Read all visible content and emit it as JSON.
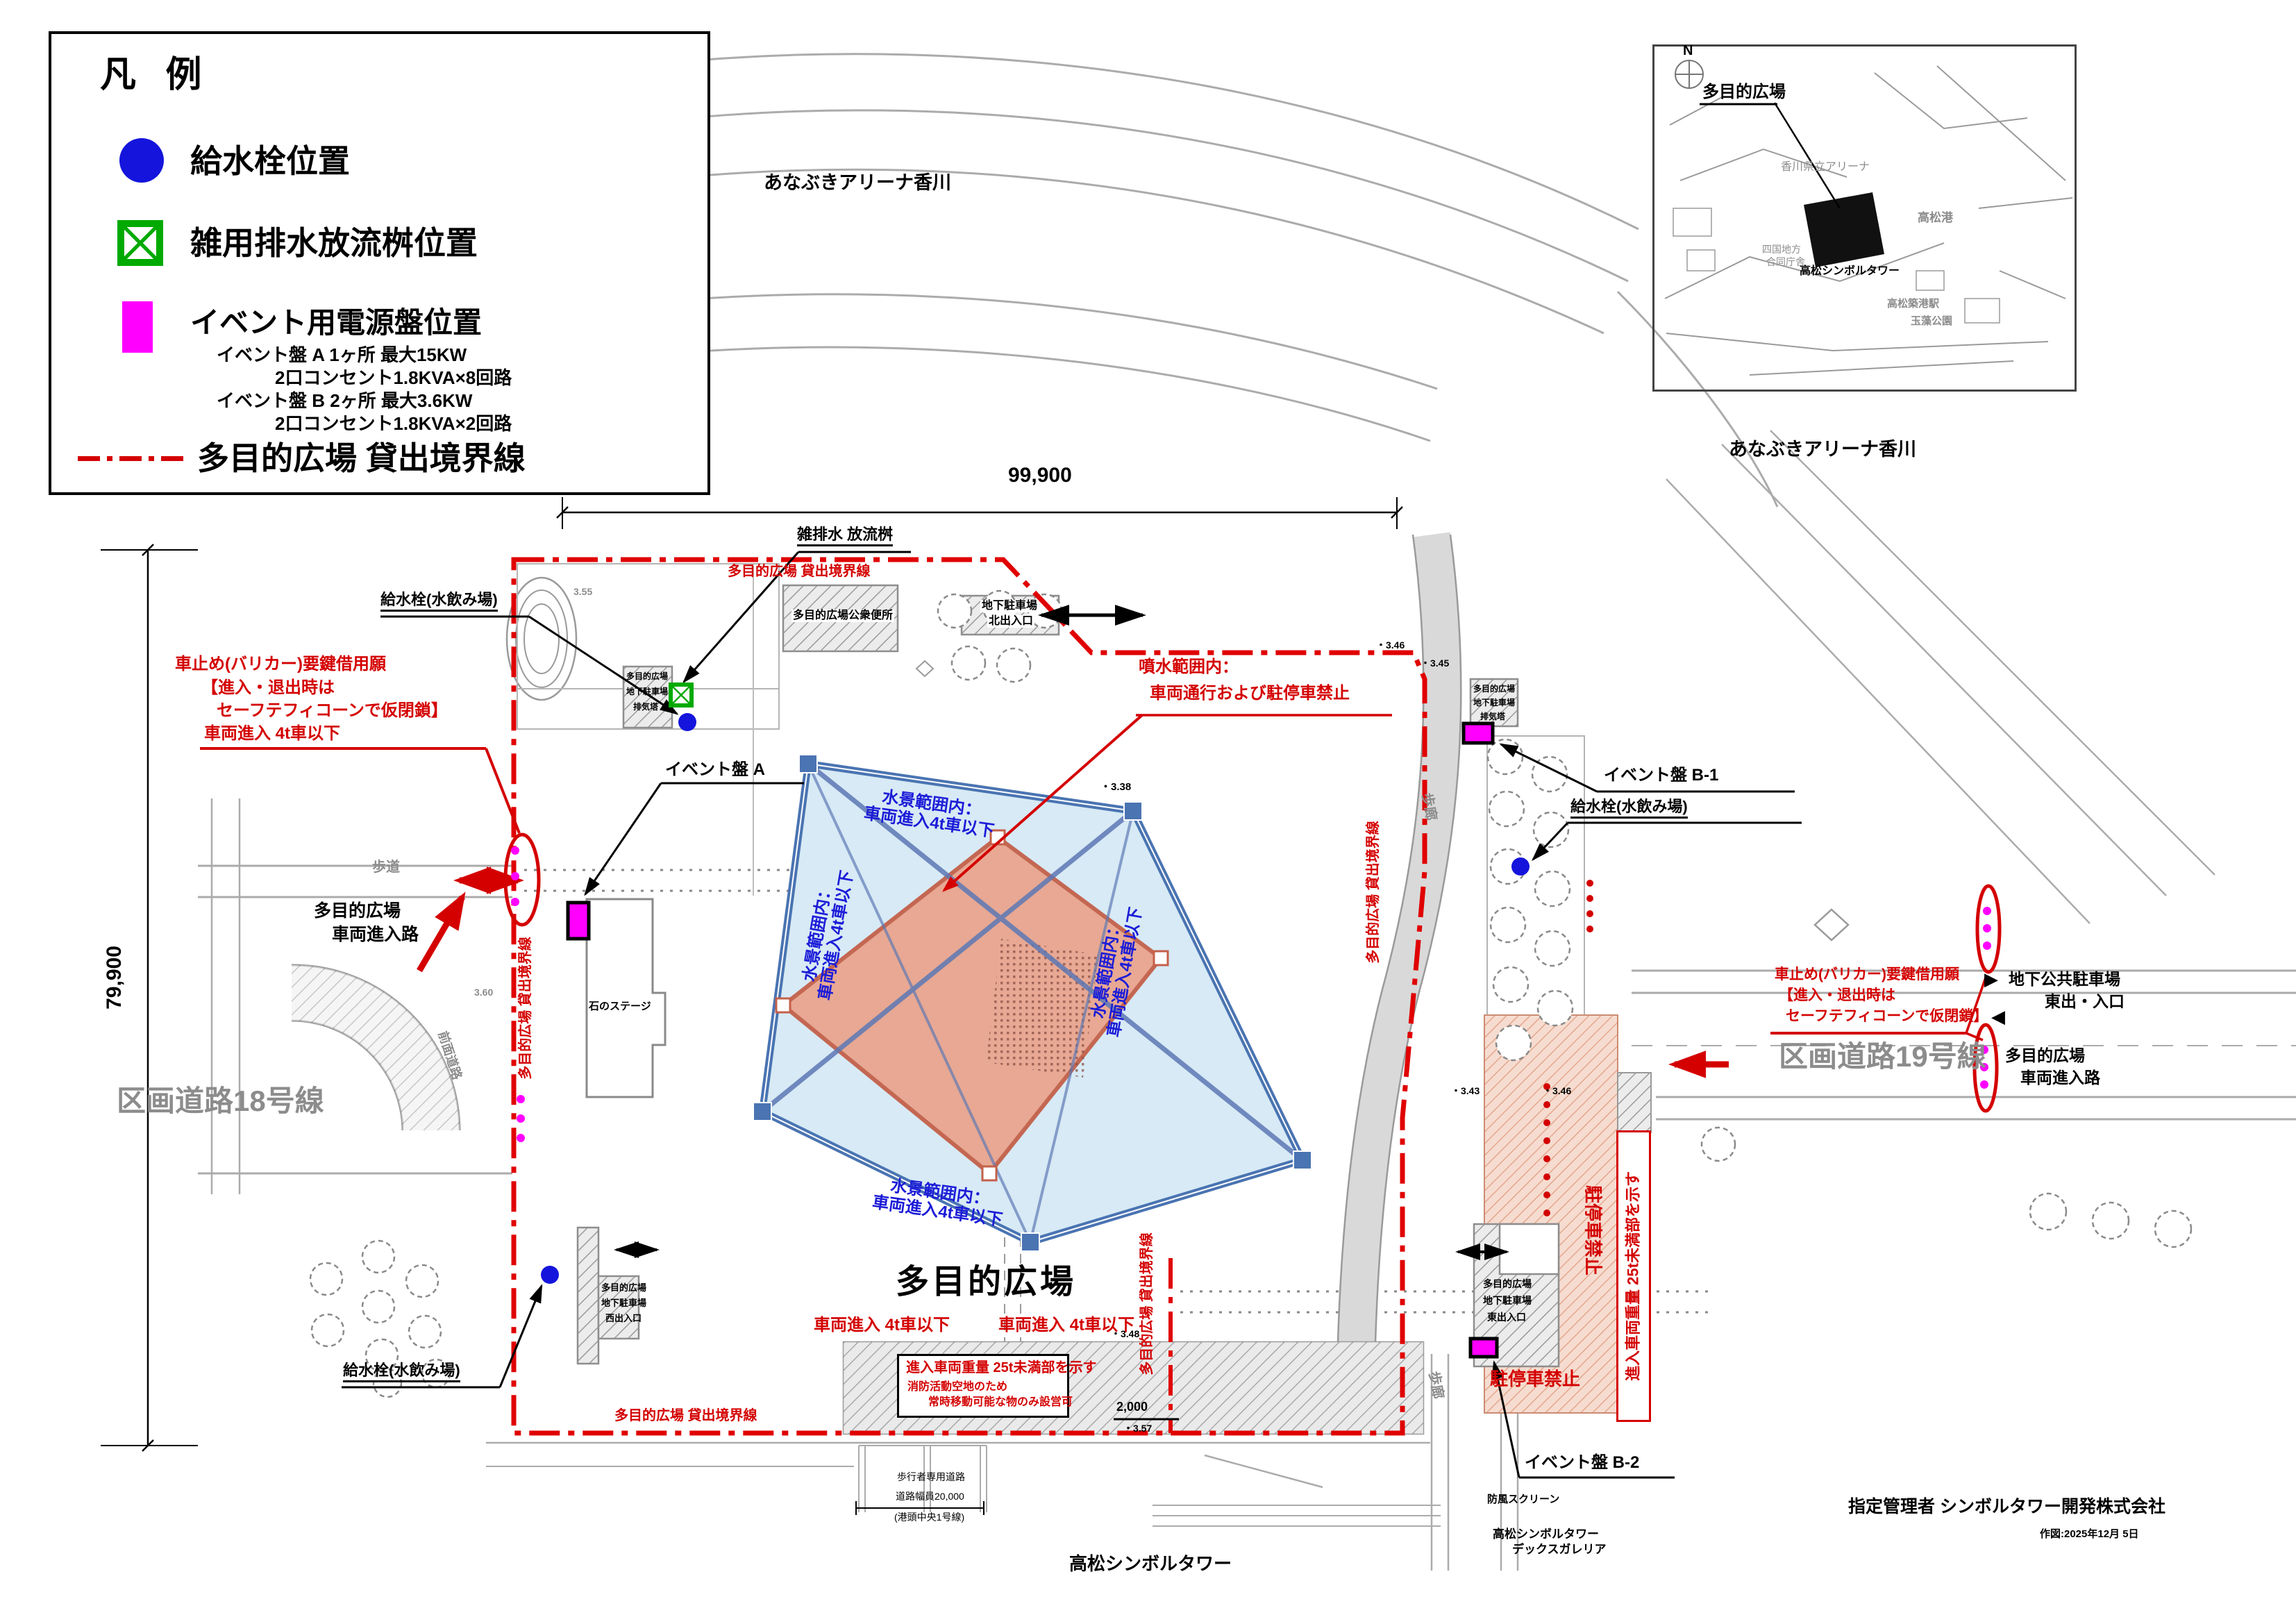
{
  "legend": {
    "title": "凡 例",
    "water_tap": "給水栓位置",
    "drain": "雑用排水放流桝位置",
    "power": "イベント用電源盤位置",
    "power_a": "イベント盤 A 1ヶ所 最大15KW",
    "power_a2": "2口コンセント1.8KVA×8回路",
    "power_b": "イベント盤 B 2ヶ所 最大3.6KW",
    "power_b2": "2口コンセント1.8KVA×2回路",
    "boundary": "多目的広場 貸出境界線"
  },
  "inset": {
    "north": "N",
    "plaza": "多目的広場",
    "arena": "香川県立アリーナ",
    "tower": "高松シンボルタワー",
    "port": "高松港",
    "gov1": "四国地方",
    "gov2": "合同庁舎",
    "station": "高松築港駅",
    "park": "玉藻公園",
    "caption": "あなぶきアリーナ香川"
  },
  "dims": {
    "width": "99,900",
    "height": "79,900",
    "gap": "2,000",
    "walk1": "歩行者専用道路",
    "walk2": "道路幅員20,000",
    "walk3": "(港頭中央1号線)"
  },
  "labels": {
    "arena_top": "あなぶきアリーナ香川",
    "plaza": "多目的広場",
    "ug_parking": "地下駐車場",
    "north_exit": "北出入口",
    "west_exit": "西出入口",
    "east_exit": "東出入口",
    "vent": "排気塔",
    "toilet": "多目的広場公衆便所",
    "stone_stage": "石のステージ",
    "road18": "区画道路18号線",
    "road19": "区画道路19号線",
    "sidewalk": "歩道",
    "front_road": "前面道路",
    "walkway": "歩廊",
    "drain": "雑排水 放流桝",
    "water_tap": "給水栓(水飲み場)",
    "event_a": "イベント盤 A",
    "event_b1": "イベント盤 B-1",
    "event_b2": "イベント盤 B-2",
    "entry1": "多目的広場",
    "entry2": "車両進入路",
    "parking_east1": "地下公共駐車場",
    "parking_east2": "東出・入口",
    "tower": "高松シンボルタワー",
    "deck1": "高松シンボルタワー",
    "deck2": "デックスガレリア",
    "windscreen": "防風スクリーン"
  },
  "red": {
    "boundary": "多目的広場 貸出境界線",
    "barricade1": "車止め(バリカー)要鍵借用願",
    "barricade2": "【進入・退出時は",
    "barricade3": "セーフテフィコーンで仮閉鎖】",
    "barricade4": "車両進入 4t車以下",
    "fountain1": "噴水範囲内：",
    "fountain2": "車両通行および駐停車禁止",
    "vehicle4t": "車両進入 4t車以下",
    "no_parking": "駐停車禁止",
    "weight1": "進入車両重量 25t未満部を示す",
    "weight2": "消防活動空地のため",
    "weight3": "常時移動可能な物のみ設営可"
  },
  "blue": {
    "range1": "水景範囲内：",
    "range2": "車両進入4t車以下"
  },
  "elev": {
    "e338": "・3.38",
    "e343": "・3.43",
    "e345": "・3.45",
    "e346": "・3.46",
    "e348": "・3.48",
    "e357": "・3.57",
    "e360": "3.60",
    "e355": "3.55"
  },
  "footer": {
    "manager": "指定管理者 シンボルタワー開発株式会社",
    "date": "作図:2025年12月 5日"
  },
  "colors": {
    "accent_red": "#d40000",
    "tap_blue": "#1414dc",
    "drain_green": "#00aa00",
    "panel_magenta": "#ff00ff",
    "water_blue": "#4a74b2",
    "water_fill": "#d7eaf5",
    "stage_salmon": "#e9a58e"
  }
}
